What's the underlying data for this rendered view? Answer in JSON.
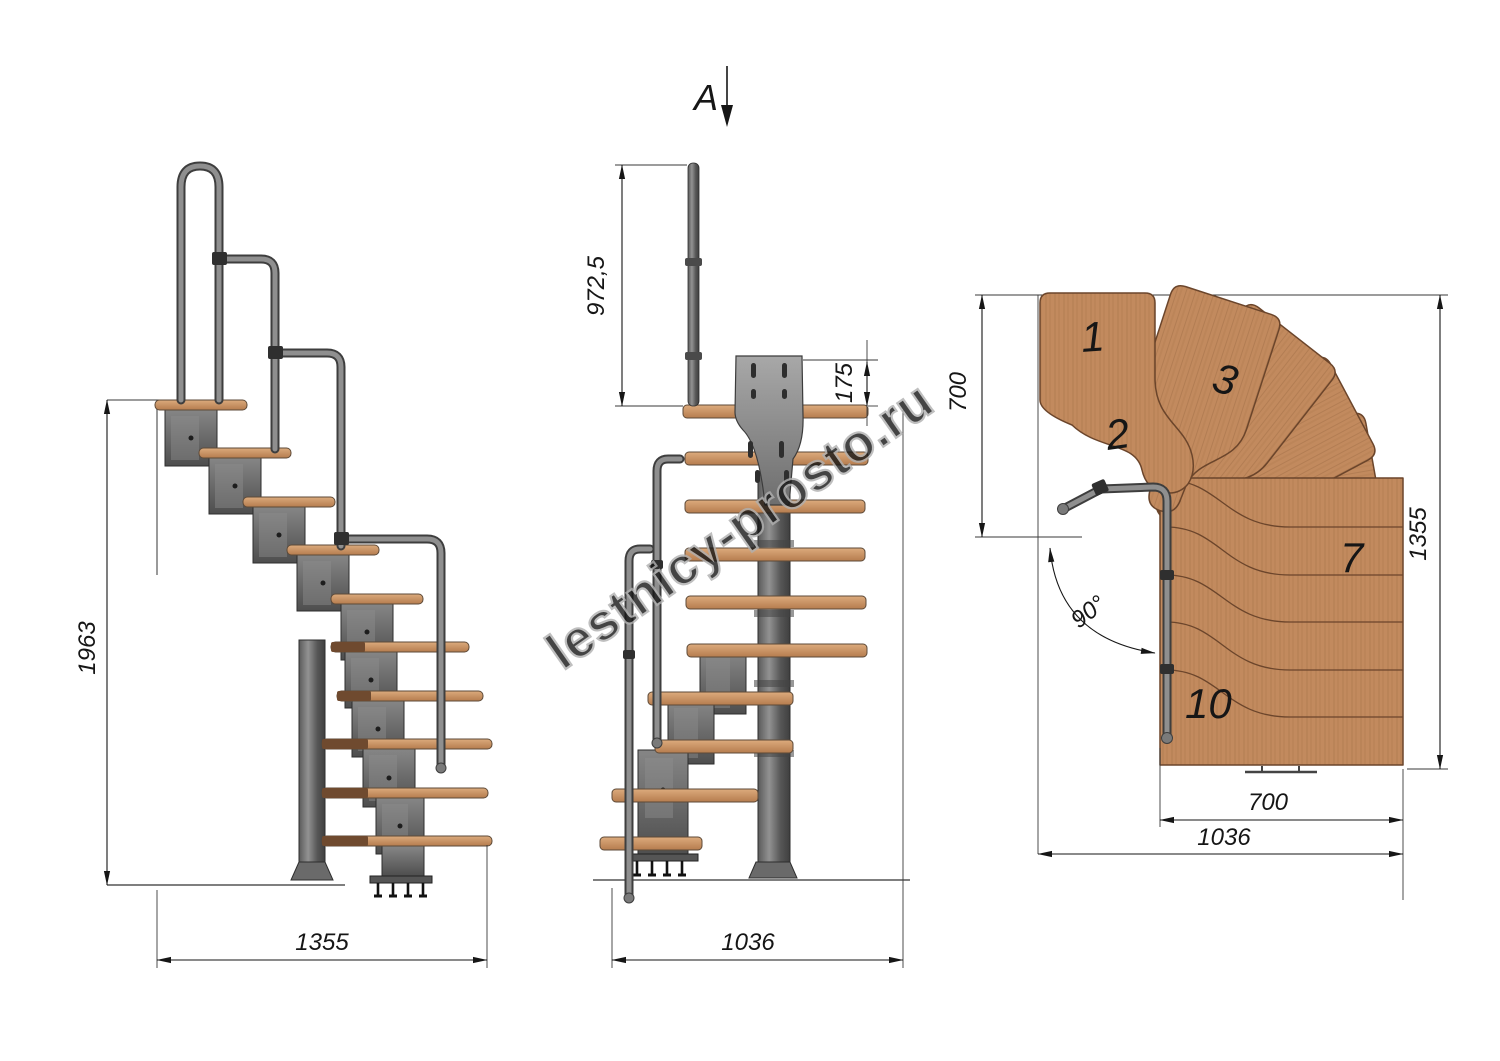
{
  "title": "Modular staircase technical drawing",
  "section_label": "A",
  "watermark": "lestnicy-prosto.ru",
  "views": {
    "side": {
      "name": "side elevation",
      "dims": {
        "height": "1963",
        "length": "1355"
      }
    },
    "front": {
      "name": "front elevation (view A)",
      "dims": {
        "rail_height": "972,5",
        "bracket_height": "175",
        "width": "1036"
      }
    },
    "plan": {
      "name": "plan view",
      "dims": {
        "entry_depth": "700",
        "length": "1355",
        "flight_width": "700",
        "total_width": "1036",
        "turn_angle": "90°"
      },
      "step_numbers": [
        "1",
        "2",
        "3",
        "7",
        "10"
      ]
    }
  },
  "colors": {
    "wood_light": "#dcab7d",
    "wood_dark": "#b57c4e",
    "plan_wood": "#c28a5e",
    "metal_dark": "#4e4e4e",
    "metal_light": "#8d8d8d",
    "line": "#161616",
    "watermark_gray": "#b0b0b0"
  }
}
